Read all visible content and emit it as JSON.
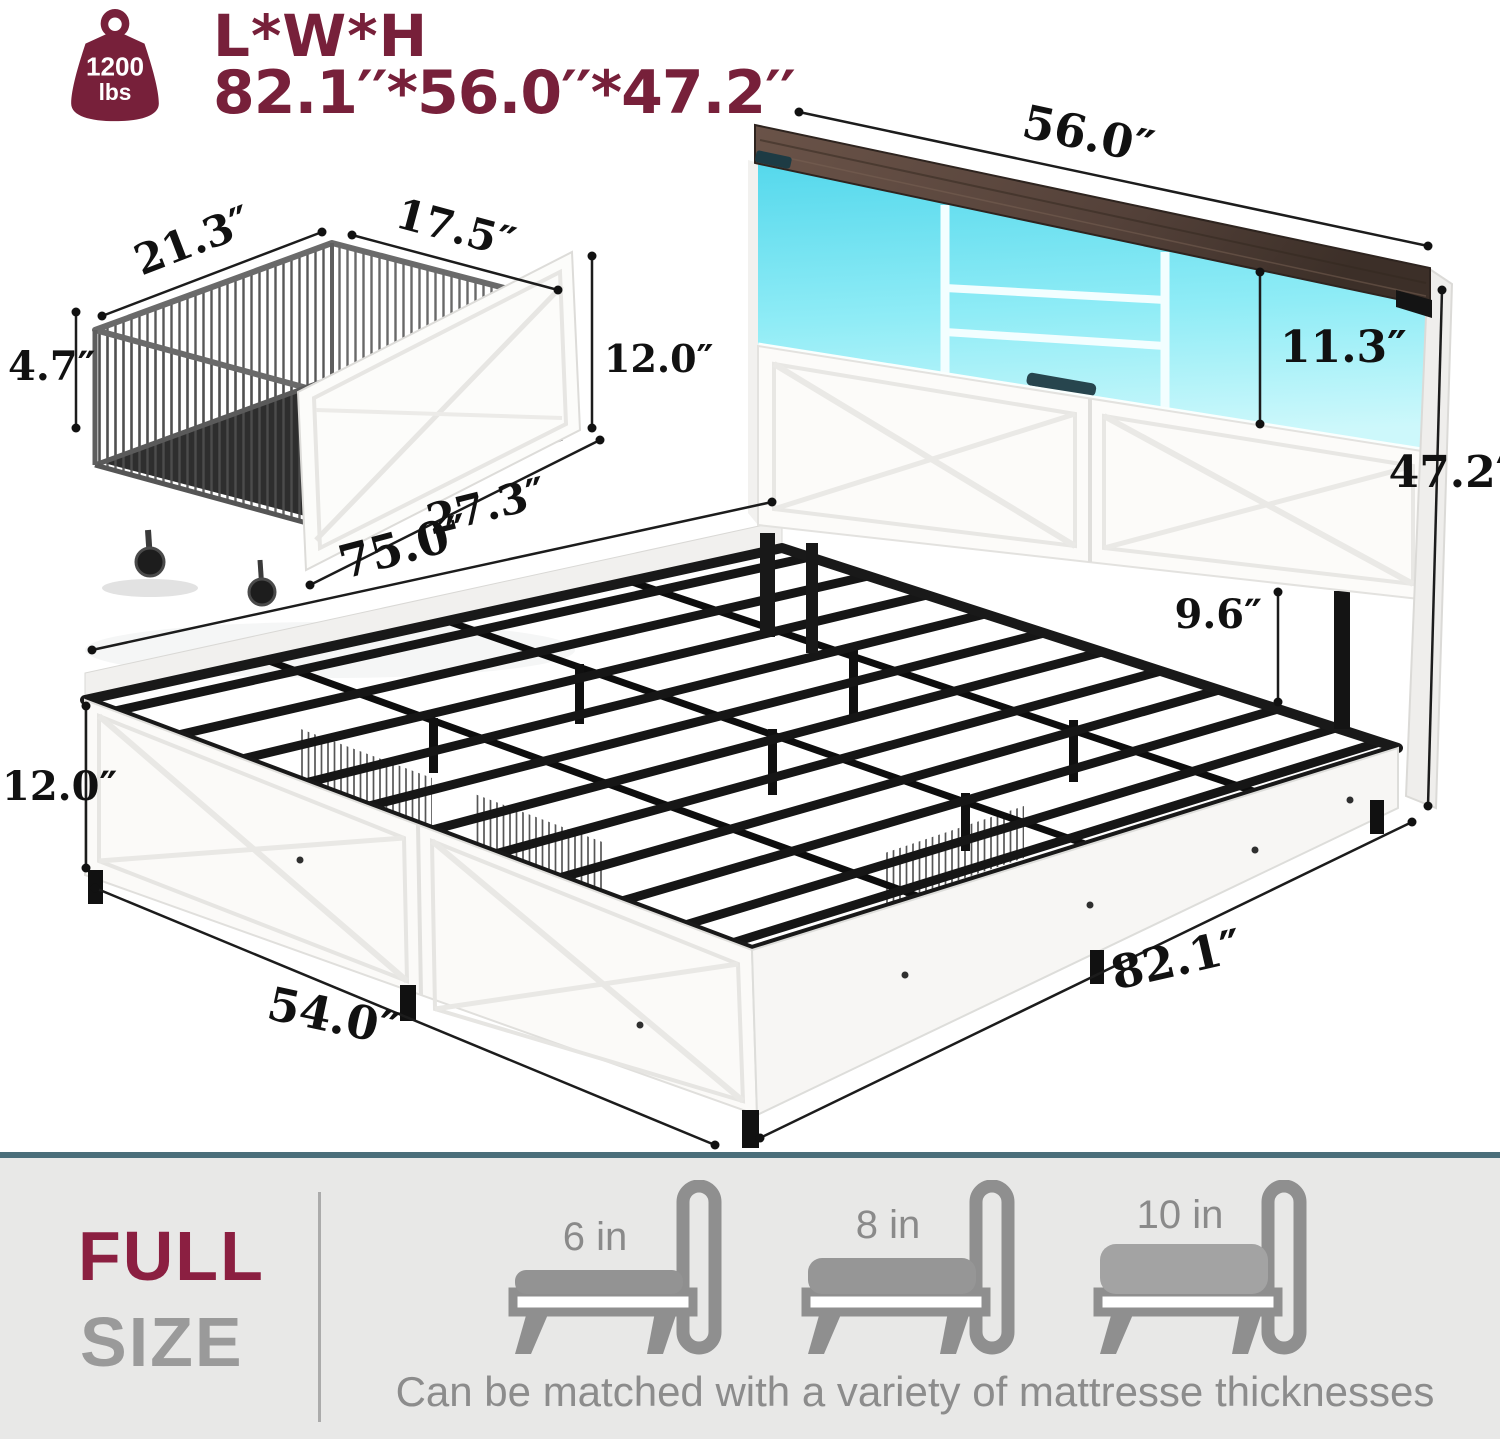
{
  "header": {
    "capacity_value": "1200",
    "capacity_unit": "lbs",
    "dims_title": "L*W*H",
    "dims_value": "82.1′′*56.0′′*47.2′′"
  },
  "drawer_diagram": {
    "top_width": "21.3″",
    "top_depth": "17.5″",
    "basket_height": "4.7″",
    "front_height": "12.0″",
    "front_length": "27.3″"
  },
  "bed_diagram": {
    "headboard_width": "56.0″",
    "cubby_height": "11.3″",
    "total_height": "47.2″",
    "slat_length": "75.0″",
    "under_bed_clearance": "9.6″",
    "side_height": "12.0″",
    "foot_width": "54.0″",
    "bed_length": "82.1″"
  },
  "footer": {
    "size_word_1": "FULL",
    "size_word_2": "SIZE",
    "mattress_options": [
      "6 in",
      "8 in",
      "10 in"
    ],
    "note": "Can be matched with a variety of mattresse thicknesses"
  },
  "colors": {
    "maroon": "#77203a",
    "full_maroon": "#8b1f41",
    "led_cyan": "#6fe2f1",
    "teal_divider": "#4a6e7a",
    "panel_gray": "#e8e8e7",
    "text_gray": "#8c8c8c"
  }
}
